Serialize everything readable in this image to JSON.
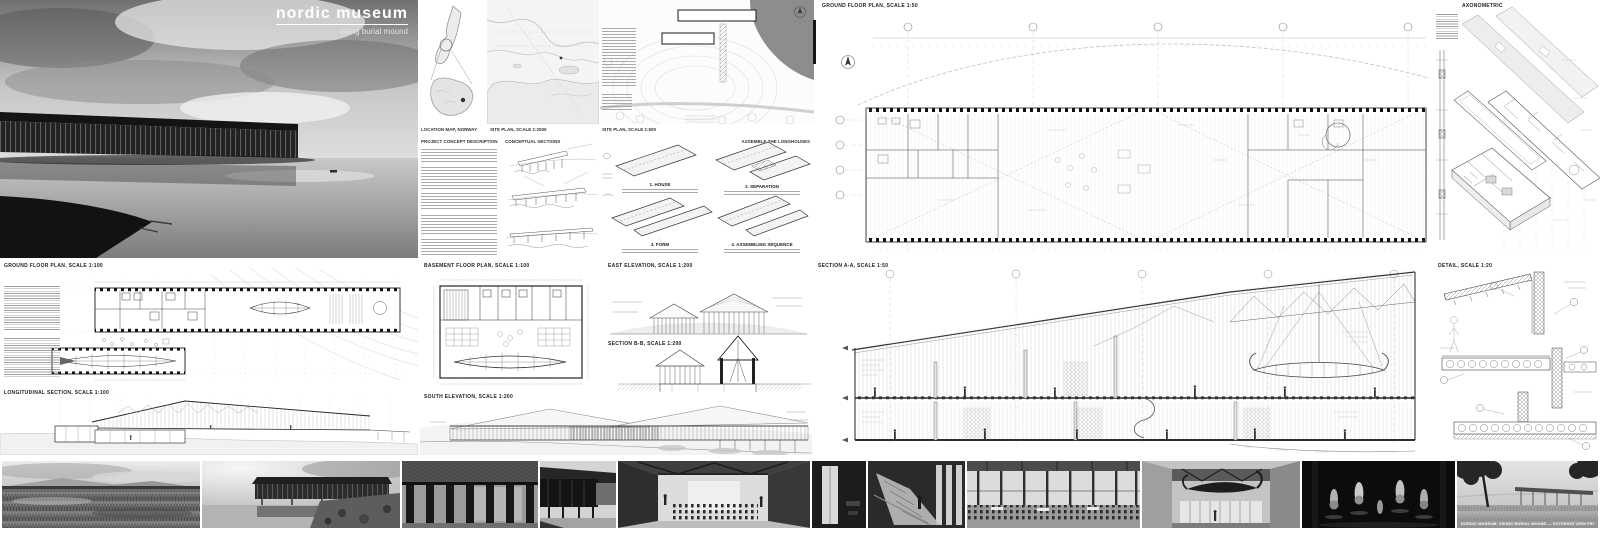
{
  "board": {
    "title": "nordic museum",
    "subtitle": "viking burial mound"
  },
  "captions": {
    "location_map": "LOCATION MAP, NORWAY",
    "coast_map": "SITE PLAN, SCALE 1:2000",
    "site_plan": "SITE PLAN, SCALE 1:500",
    "concept_text": "PROJECT CONCEPT DESCRIPTION",
    "concept_sections": "CONCEPTUAL SECTIONS",
    "assembly": "ASSEMBLE THE LONGHOUSES",
    "step1": "1. HOUSE",
    "step2": "2. SEPARATION",
    "step3": "3. FORM",
    "step4": "4. ASSEMBLING SEQUENCE",
    "ground_plan_50": "GROUND FLOOR PLAN, SCALE 1:50",
    "axonometric": "AXONOMETRIC",
    "ground_plan_100": "GROUND FLOOR PLAN, SCALE 1:100",
    "longitudinal_section": "LONGITUDINAL SECTION, SCALE 1:100",
    "basement_plan": "BASEMENT FLOOR PLAN, SCALE 1:100",
    "east_elevation": "EAST ELEVATION, SCALE 1:200",
    "cross_section": "SECTION B-B, SCALE 1:200",
    "south_elevation": "SOUTH ELEVATION, SCALE 1:200",
    "main_section": "SECTION A-A, SCALE 1:50",
    "detail": "DETAIL, SCALE 1:20",
    "photo_caption": "NORDIC MUSEUM, VIKING BURIAL MOUND — EXTERIOR VIEW FROM THE MEADOW"
  },
  "colors": {
    "paper": "#ffffff",
    "ink": "#1a1a1a",
    "line_light": "#bbbbbb",
    "water": "#8d8d8d",
    "photo_dark": "#141414"
  }
}
